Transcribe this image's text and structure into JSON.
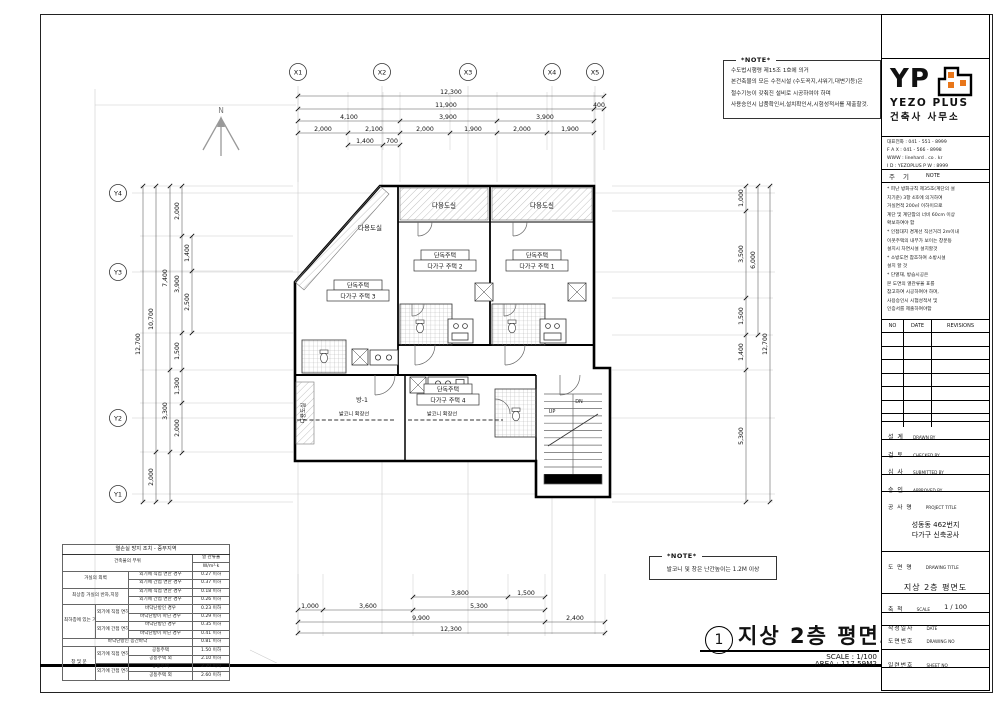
{
  "note_top": {
    "title": "*NOTE*",
    "body": "수도법시행령 제15조 1호에 의거\n본건축물의 모든 수전시설 (수도꼭지,샤워기,대변기등)은\n절수기능이 갖춰진 설비로 시공하여야 하며\n사용승인시 납품확인서,설치확인서,시험성적서를 제출할것."
  },
  "note_bottom": {
    "title": "*NOTE*",
    "body": "발코니 및 창은 난간높이는 1.2M 이상"
  },
  "title_area": {
    "num": "1",
    "title": "지상 2층 평면도",
    "scale": "SCALE : 1/100",
    "area": "AREA : 117.59M2"
  },
  "grid": {
    "x": [
      "X1",
      "X2",
      "X3",
      "X4",
      "X5"
    ],
    "y": [
      "Y4",
      "Y3",
      "Y2",
      "Y1"
    ]
  },
  "dims": {
    "top": {
      "r1": "12,300",
      "r2a": "11,900",
      "r2b": "400",
      "r3": [
        "4,100",
        "3,900",
        "3,900"
      ],
      "r4": [
        "2,000",
        "2,100",
        "2,000",
        "1,900",
        "2,000",
        "1,900"
      ],
      "r5": [
        "1,400",
        "700"
      ]
    },
    "left": {
      "total": "12,700",
      "sub": "10,700",
      "sub_b": "2,000",
      "c3": [
        "7,400",
        "3,300"
      ],
      "c4": [
        "2,000",
        "3,900",
        "1,500",
        "1,300",
        "2,000"
      ],
      "c5": [
        "1,400",
        "2,500"
      ]
    },
    "right": {
      "segs": [
        "1,000",
        "3,500",
        "1,500",
        "1,400",
        "5,300"
      ],
      "mid": "6,000",
      "total": "12,700"
    },
    "bottom": {
      "r1": [
        "3,800",
        "1,500"
      ],
      "r2": [
        "1,000",
        "3,600",
        "5,300"
      ],
      "r3": [
        "9,900",
        "2,400"
      ],
      "r4": "12,300"
    }
  },
  "plan": {
    "north": "N",
    "utility": "다용도실",
    "unit_top": "단독주택",
    "unit1": "다가구 주택 1",
    "unit2": "다가구 주택 2",
    "unit3": "다가구 주택 3",
    "unit4": "다가구 주택 4",
    "room1": "방-1",
    "balcony": "발코니 확장선",
    "up": "UP",
    "dn": "DN"
  },
  "tb": {
    "logo_text": "YP",
    "logo_name": "YEZO PLUS",
    "logo_sub": "건축사 사무소",
    "logo_accent": "#E8761A",
    "contact": "대표전화 : 041 - 551 - 8999\nF A X : 041 - 566 - 8998\nWWW : linehard . co . kr\nI D : YEZOPLUS  P W : 8999",
    "note_kr": "주  기",
    "note_en": "NOTE",
    "note_body": "* 피난 방화규칙 제35조(계단의 설\n  치기준) 3항 4호에 의거하여\n  거실면적 200㎡ 이하이므로\n  계단 및 계단참의 너비 60cm 이상\n  확보하여야 함\n* 인접대지 경계선 직선거리 2m이내\n  이웃주택의 내부가 보이는 창문등\n  설치시 차면시설 설치할것\n* 소방도면 참조하여 소방시설\n  설치 할 것\n* 단열재, 방습시공은\n  본 도면의 열관류율 표를\n  참고하여 시공하여야 하며,\n  사용승인시 시험성적서 및\n  인증서를 제출하여야함",
    "rev_no": "NO",
    "rev_date": "DATE",
    "rev_rev": "REVISIONS",
    "sign": [
      {
        "kr": "설  계",
        "en": "DRAWN  BY"
      },
      {
        "kr": "검  토",
        "en": "CHECKED  BY"
      },
      {
        "kr": "심  사",
        "en": "SUBMITTED  BY"
      },
      {
        "kr": "승  인",
        "en": "APPROVED  BY"
      }
    ],
    "proj_kr": "공 사 명",
    "proj_en": "PROJECT TITLE",
    "proj_name": "성동동 462번지\n다가구 신축공사",
    "dwg_kr": "도 면 명",
    "dwg_en": "DRAWING TITLE",
    "dwg_name": "지상 2층 평면도",
    "scale_kr": "축  척",
    "scale_en": "SCALE",
    "scale_val": "1 / 100",
    "date_kr": "작성일자",
    "date_en": "DATE",
    "no_kr": "도면번호",
    "no_en": "DRAWING NO",
    "sheet_kr": "일련번호",
    "sheet_en": "SHEET NO"
  },
  "heat": {
    "title": "열손실 방지 조치 - 중부지역",
    "part": "건축물의 부위",
    "u1": "열 관류율",
    "u2": "W/m²·k",
    "r1a": "거실의 외벽",
    "r1b": "외기에 직접 면한 경우",
    "r1v": "0.27 이하",
    "r2b": "외기에 간접 면한 경우",
    "r2v": "0.37 이하",
    "r3a": "최상층 거실의 반자,지붕",
    "r3b": "외기에 직접 면한 경우",
    "r3v": "0.18 이하",
    "r4b": "외기에 간접 면한 경우",
    "r4v": "0.26 이하",
    "r5a": "최하층에 있는 거실의 바닥",
    "r5b": "외기에 직접 면하는 경우",
    "r5c": "바닥난방인 경우",
    "r5v": "0.23 이하",
    "r6c": "바닥난방이 아닌 경우",
    "r6v": "0.29 이하",
    "r7b": "외기에 간접 면하는 경우",
    "r7c": "바닥난방인 경우",
    "r7v": "0.35 이하",
    "r8c": "바닥난방이 아닌 경우",
    "r8v": "0.41 이하",
    "r9a": "바닥난방인 층간바닥",
    "r9v": "0.81 이하",
    "r10a": "창 및 문",
    "r10b": "외기에 직접 면하는 경우",
    "r10c": "공동주택",
    "r10v": "1.50 이하",
    "r11c": "공동주택 외",
    "r11v": "2.10 이하",
    "r12b": "외기에 간접 면하는 경우",
    "r12c": "공동주택",
    "r12v": "2.20 이하",
    "r13c": "공동주택 외",
    "r13v": "2.60 이하"
  }
}
